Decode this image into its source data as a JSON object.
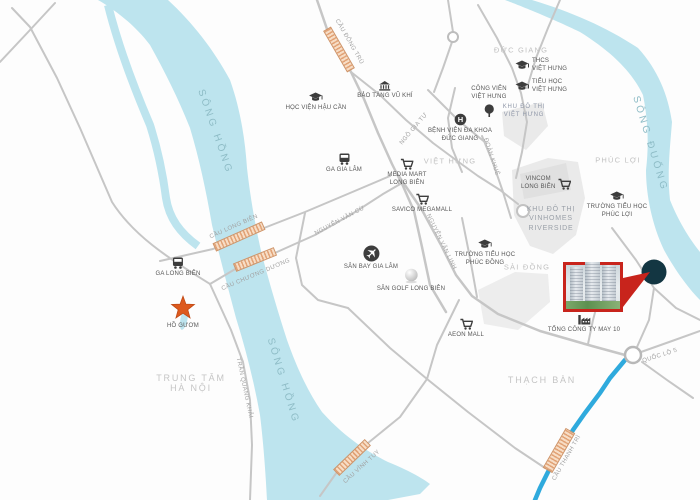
{
  "map": {
    "rivers": {
      "song_hong_top": "SÔNG HỒNG",
      "song_hong_bottom": "SÔNG HỒNG",
      "song_duong": "SÔNG ĐUỐNG"
    },
    "areas": {
      "duc_giang": "ĐỨC GIANG",
      "viet_hung": "VIỆT HƯNG",
      "phuc_loi": "PHÚC LỢI",
      "sai_dong": "SÀI ĐỒNG",
      "thach_ban": "THẠCH BÀN",
      "trung_tam_ha_noi": "TRUNG TÂM\nHÀ NỘI"
    },
    "roads": {
      "cau_dong_tru": "CẦU ĐÔNG TRÙ",
      "ngo_gia_tu": "NGÔ GIA TỰ",
      "cau_long_bien": "CẦU LONG BIÊN",
      "cau_chuong_duong": "CẦU CHƯƠNG DƯƠNG",
      "nguyen_van_cu": "NGUYỄN VĂN CỪ",
      "nguyen_van_linh": "NGUYỄN VĂN LINH",
      "doan_khue": "ĐOÀN KHUÊ",
      "tran_quang_khai": "TRẦN QUANG KHẢI",
      "quoc_lo_5": "QUỐC LỘ 5",
      "cau_vinh_tuy": "CẦU VĨNH TUY",
      "cau_thanh_tri": "CẦU THANH TRÌ"
    },
    "zones": {
      "kdt_viet_hung": "KHU ĐÔ THỊ\nVIỆT HƯNG",
      "vinhomes": "KHU ĐÔ THỊ\nVINHOMES\nRIVERSIDE"
    },
    "pois": {
      "hoc_vien_hau_can": "HỌC VIỆN HẬU CẦN",
      "bao_tang_vu_khi": "BẢO TÀNG VŨ KHÍ",
      "ga_gia_lam": "GA GIA LÂM",
      "ga_long_bien": "GA LONG BIÊN",
      "media_mart": "MEDIA MART\nLONG BIÊN",
      "savico": "SAVICO MEGAMALL",
      "cong_vien_viet_hung": "CÔNG VIÊN\nVIỆT HƯNG",
      "benh_vien_duc_giang": "BỆNH VIỆN ĐA KHOA\nĐỨC GIANG",
      "thcs_viet_hung": "THCS\nVIỆT HƯNG",
      "tieu_hoc_viet_hung": "TIỂU HỌC\nVIỆT HƯNG",
      "truong_th_phuc_loi": "TRƯỜNG TIỂU HỌC\nPHÚC LỢI",
      "truong_th_phuc_dong": "TRƯỜNG TIỂU HỌC\nPHÚC ĐỒNG",
      "san_bay_gia_lam": "SÂN BAY GIA LÂM",
      "san_golf_long_bien": "SÂN GOLF LONG BIÊN",
      "aeon_mall": "AEON MALL",
      "may_10": "TỔNG CÔNG TY MAY 10",
      "vincom_long_bien": "VINCOM\nLONG BIÊN",
      "ho_guom": "HỒ GƯƠM"
    },
    "colors": {
      "river": "#bde4ee",
      "road": "#c6c6c6",
      "bridge": "#e2a377",
      "highway_blue": "#2faadd",
      "star_orange": "#dd5a1e",
      "project_marker": "#133642",
      "photo_border": "#c8241c",
      "zone_fill": "#eaeaea"
    }
  }
}
